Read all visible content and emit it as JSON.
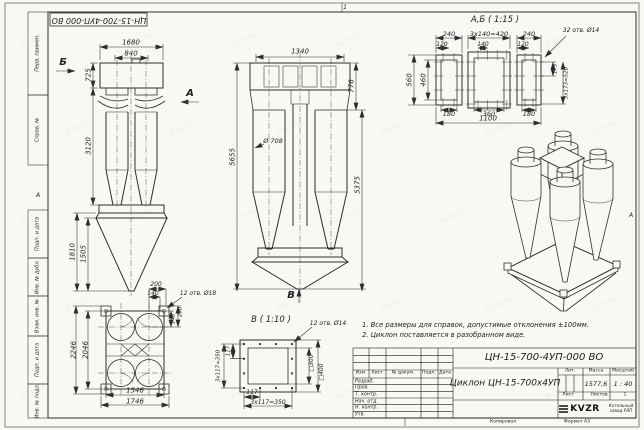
{
  "doc": {
    "code": "ЦН-15-700-4УП-000 ВО",
    "name": "Циклон ЦН-15-700х4УП",
    "mass": "1577,6",
    "scale": "1 : 40",
    "sheet_count": "1",
    "copied_label": "Копировал",
    "format_label": "Формат А3",
    "logo": "KVZR",
    "company": "Котельный завод РЭП"
  },
  "frame": {
    "stamp_code": "ЦН-15-700-4УП-000 ВО",
    "zone_top": "1",
    "zone_left": "А",
    "zone_right": "А",
    "side_labels": [
      "Перв. примен.",
      "Справ. №",
      "Подп. и дата",
      "Инв. № дубл.",
      "Взам. инв. №",
      "Подп. и дата",
      "Инв. № подл."
    ]
  },
  "title_block": {
    "col_izm": "Изм.",
    "col_list": "Лист",
    "col_doc": "№ докум.",
    "col_sign": "Подп.",
    "col_date": "Дата",
    "rows": [
      "Разраб.",
      "Пров.",
      "Т. контр.",
      "Нач. отд.",
      "Н. контр.",
      "Утв."
    ],
    "lit_label": "Лит.",
    "mass_label": "Масса",
    "scale_label": "Масштаб",
    "sheet_label": "Лист",
    "sheets_label": "Листов"
  },
  "notes": {
    "line1": "1. Все размеры для справок, допустимые отклонения ±100мм.",
    "line2": "2. Циклон поставляется в разобранном виде."
  },
  "views": {
    "side": {
      "b": "Б",
      "a": "А",
      "d1680": "1680",
      "d840": "840",
      "d725": "725",
      "d3120": "3120",
      "d1810": "1810",
      "d1505": "1505"
    },
    "front": {
      "d1340": "1340",
      "d776": "776",
      "d708": "Ø 708",
      "d5655": "5655",
      "d5375": "5375",
      "v": "В"
    },
    "ab": {
      "title": "А,Б ( 1:15 )",
      "d240a": "240",
      "d420": "3х140=420",
      "d240b": "240",
      "holes": "32 отв. Ø14",
      "d120a": "120",
      "d140": "140",
      "d120b": "120",
      "d560": "560",
      "d460": "460",
      "d173": "173",
      "d520": "3х173=520",
      "d180a": "180",
      "d360": "360",
      "d180b": "180",
      "d1100": "1100"
    },
    "plan": {
      "d200t": "200",
      "d140t": "140",
      "holes": "12 отв. Ø18",
      "d140r": "140",
      "d200r": "200",
      "d2246": "2246",
      "d2046": "2046",
      "d1546": "1546",
      "d1746": "1746"
    },
    "b": {
      "title": "В ( 1:10 )",
      "holes": "12 отв. Ø14",
      "d117l": "117",
      "d350l": "3х117=350",
      "d300": "□300",
      "d400": "□400",
      "d117b": "117",
      "d350b": "3х117=350"
    }
  },
  "watermark": {
    "text": "kvzr.ru"
  }
}
